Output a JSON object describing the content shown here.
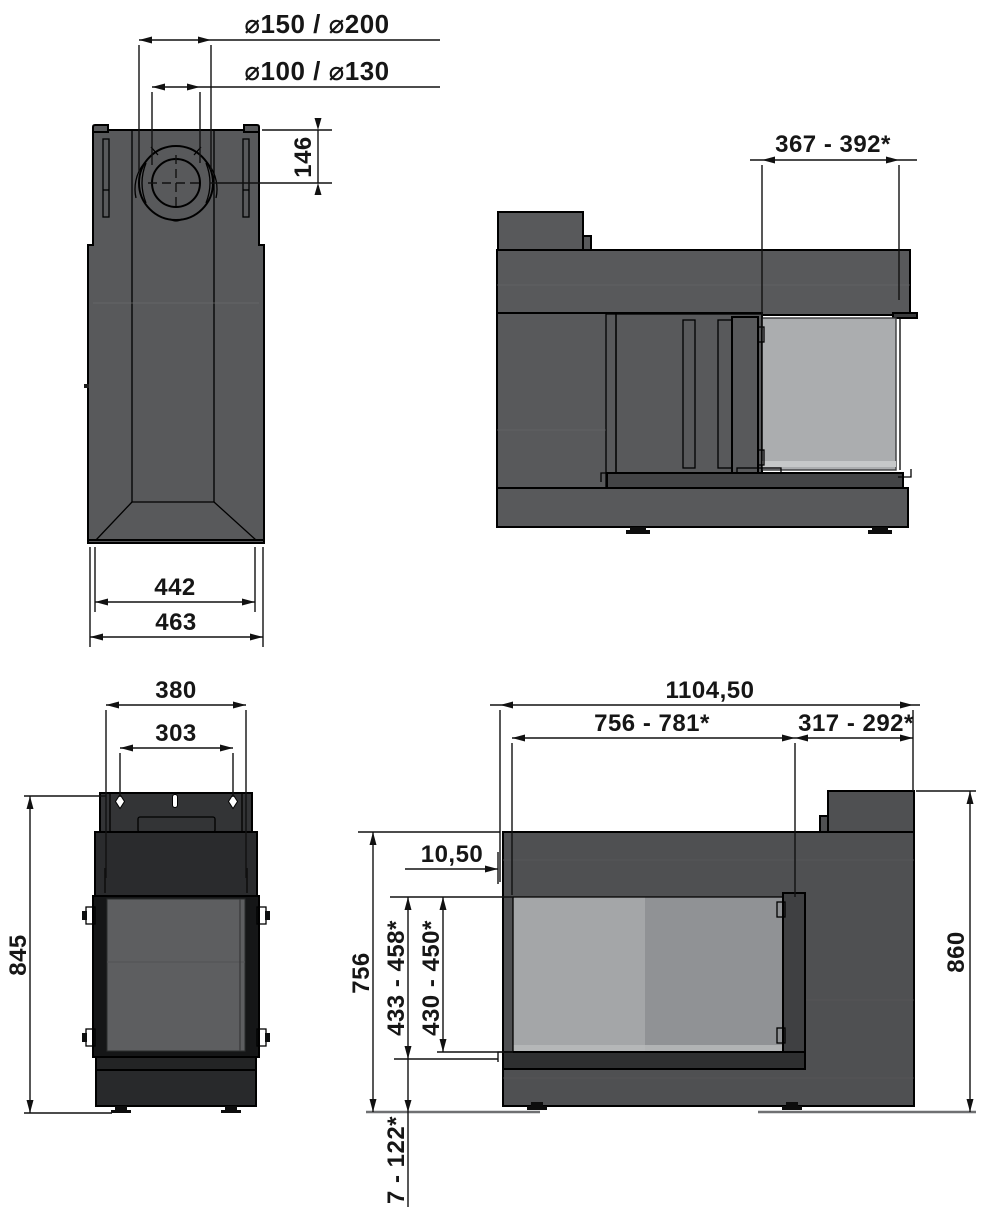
{
  "drawing": {
    "title": "fireplace-insert-technical-drawing",
    "units": "mm"
  },
  "dims": {
    "flue_outer": "⌀150 / ⌀200",
    "flue_inner": "⌀100 / ⌀130",
    "flue_center_depth": "146",
    "top_width_inner": "442",
    "top_width_outer": "463",
    "side_glass_depth": "367 - 392*",
    "front_plate_width": "380",
    "plate_hole_spacing": "303",
    "side_body_height": "845",
    "total_width": "1104,50",
    "glass_opening_width": "756 - 781*",
    "right_section_width": "317 - 292*",
    "glass_lip_offset": "10,50",
    "front_body_height": "756",
    "glass_height_outer": "433 - 458*",
    "glass_height_inner": "430 - 450*",
    "overall_height": "860",
    "floor_clearance": "7 - 122*"
  },
  "colors": {
    "body_gray": "#58595b",
    "body_gray_dark": "#4f5052",
    "near_black": "#2a2b2d",
    "glass_light": "#abadaf",
    "glass_mid_left": "#a4a6a8",
    "glass_mid_right": "#909295",
    "glass_dark": "#5d5e60",
    "line": "#000000"
  }
}
